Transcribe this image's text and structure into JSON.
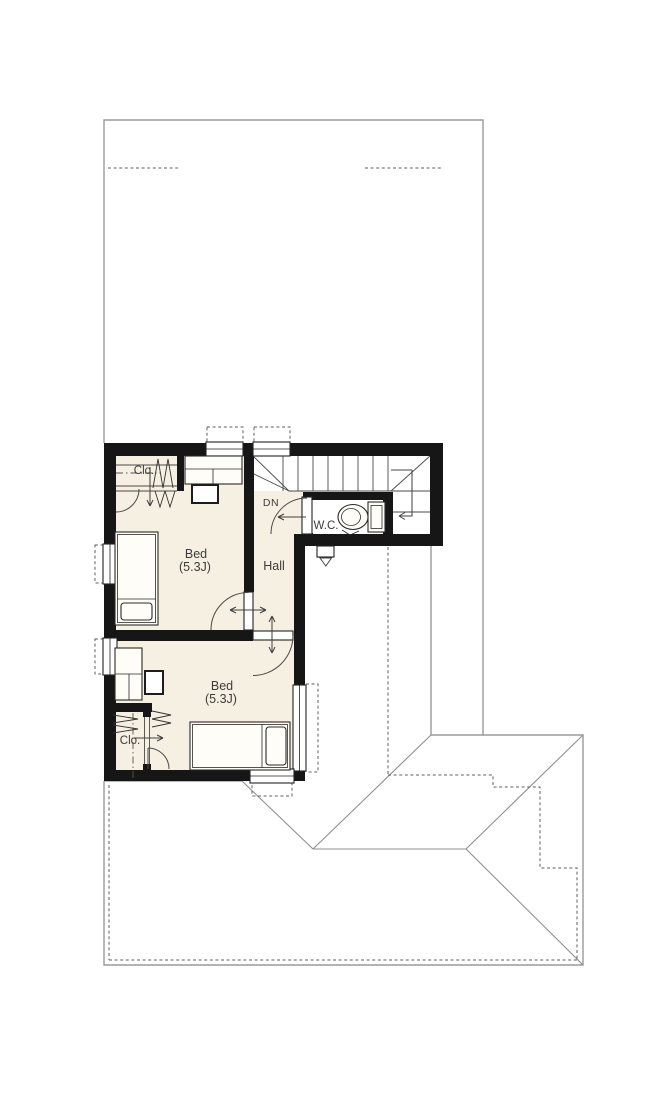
{
  "colors": {
    "bg": "#ffffff",
    "wall": "#161616",
    "floor": "#f5f0e2",
    "line": "#9a9a9a",
    "roofline": "#8f8f8f",
    "dash": "#5f5f5f",
    "furniture": "#2a2a2a",
    "text": "#3c3c3c"
  },
  "floorplan": {
    "labels": {
      "closet1": "Clo.",
      "closet2": "Clo.",
      "bedroom1_name": "Bed",
      "bedroom1_size": "(5.3J)",
      "bedroom2_name": "Bed",
      "bedroom2_size": "(5.3J)",
      "hall": "Hall",
      "wc": "W.C.",
      "stairs_down": "DN"
    },
    "rooms": [
      {
        "name": "Bed",
        "size": "(5.3J)"
      },
      {
        "name": "Bed",
        "size": "(5.3J)"
      },
      {
        "name": "Hall"
      },
      {
        "name": "W.C."
      },
      {
        "name": "Clo."
      },
      {
        "name": "Clo."
      }
    ],
    "stair_direction": "DN"
  }
}
